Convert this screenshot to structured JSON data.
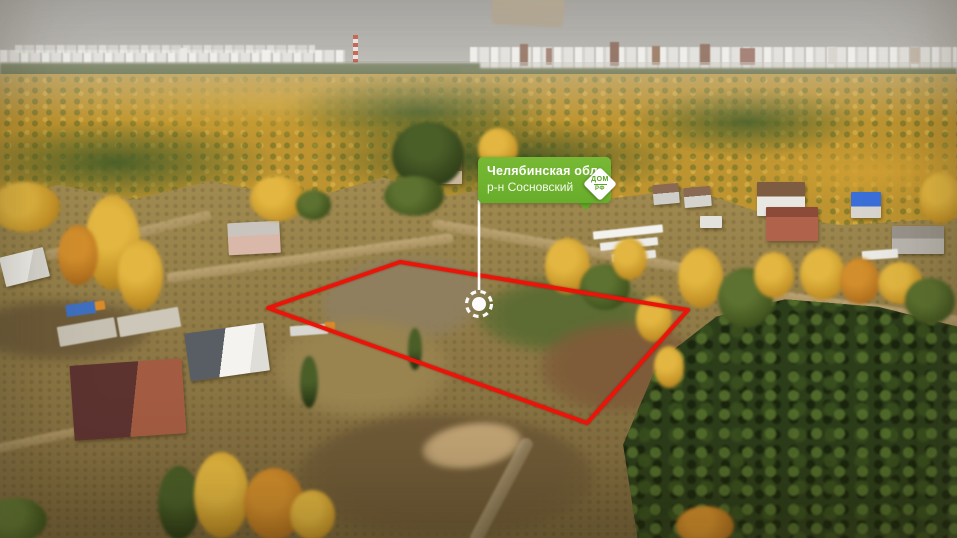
{
  "overlay": {
    "region_label": {
      "title": "Челябинская обл.",
      "district": "р-н Сосновский"
    },
    "logo": {
      "name": "dom-rf-logo",
      "line1": "ДОМ",
      "line2": "РФ"
    },
    "plot": {
      "polygon_points": "268,308 400,262 688,310 587,423",
      "outline_color": "#ec1409"
    },
    "marker": {
      "x": 479,
      "y": 304,
      "color": "#ffffff"
    },
    "label_color": "#6fb32f"
  }
}
